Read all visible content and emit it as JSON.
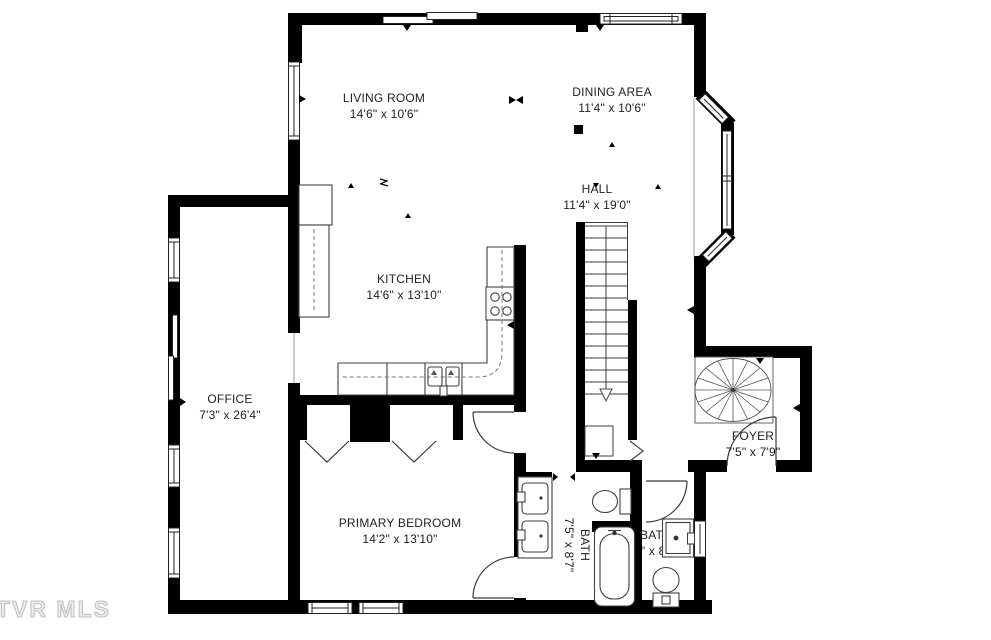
{
  "plan": {
    "watermark": "TVR MLS",
    "colors": {
      "wall": "#000000",
      "line": "#404040",
      "text": "#1f1f1f",
      "watermark": "#bfbfbf"
    },
    "rooms": [
      {
        "id": "living-room",
        "name": "LIVING ROOM",
        "dims": "14'6\" x 10'6\""
      },
      {
        "id": "dining-area",
        "name": "DINING AREA",
        "dims": "11'4\" x 10'6\""
      },
      {
        "id": "hall",
        "name": "HALL",
        "dims": "11'4\" x 19'0\""
      },
      {
        "id": "kitchen",
        "name": "KITCHEN",
        "dims": "14'6\" x 13'10\""
      },
      {
        "id": "office",
        "name": "OFFICE",
        "dims": "7'3\" x 26'4\""
      },
      {
        "id": "foyer",
        "name": "FOYER",
        "dims": "7'5\" x 7'9\""
      },
      {
        "id": "primary-bedroom",
        "name": "PRIMARY BEDROOM",
        "dims": "14'2\" x 13'10\""
      },
      {
        "id": "bath-primary",
        "name": "BATH",
        "dims": "7'5\" x 8'7\""
      },
      {
        "id": "bath-2",
        "name": "BATH",
        "dims": "3'7\" x 8'7\""
      }
    ]
  }
}
